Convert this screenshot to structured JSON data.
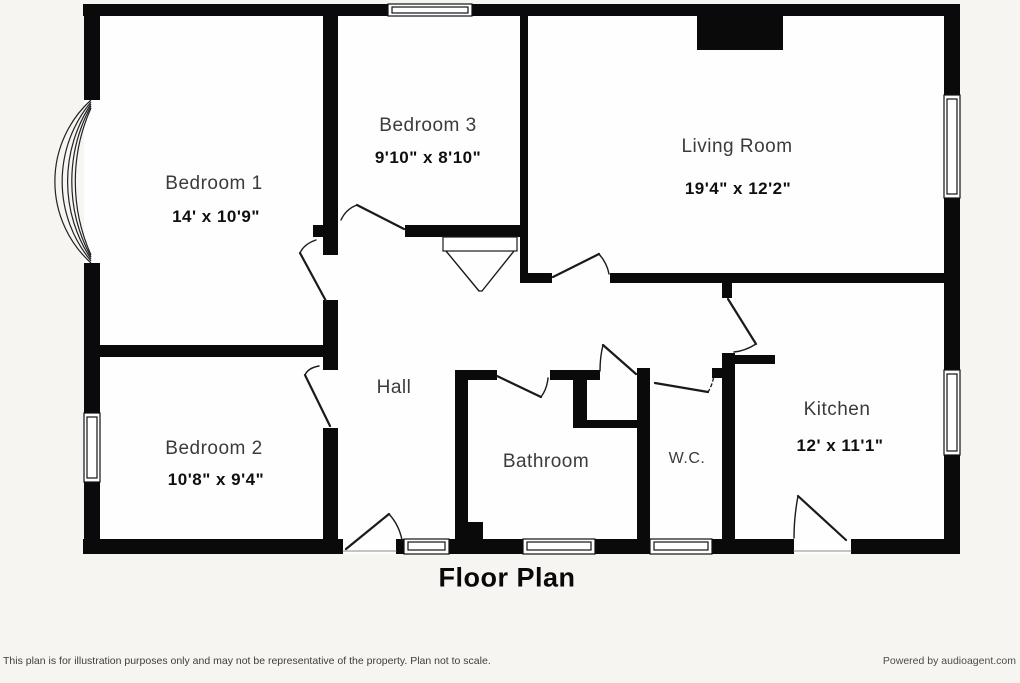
{
  "title": "Floor Plan",
  "palette": {
    "wall": "#0a0a0a",
    "room_fill": "#fefefe",
    "page_bg": "#f6f5f1",
    "label_color": "#3b3b3b",
    "dims_color": "#0f0f0f"
  },
  "rooms": {
    "bedroom1": {
      "name": "Bedroom 1",
      "dims": "14' x 10'9\""
    },
    "bedroom3": {
      "name": "Bedroom 3",
      "dims": "9'10\" x 8'10\""
    },
    "living": {
      "name": "Living Room",
      "dims": "19'4\" x 12'2\""
    },
    "bedroom2": {
      "name": "Bedroom 2",
      "dims": "10'8\" x 9'4\""
    },
    "hall": {
      "name": "Hall"
    },
    "bathroom": {
      "name": "Bathroom"
    },
    "wc": {
      "name": "W.C."
    },
    "kitchen": {
      "name": "Kitchen",
      "dims": "12' x 11'1\""
    }
  },
  "footer": {
    "disclaimer": "This plan is for illustration purposes only and may not be representative of the property. Plan not to scale.",
    "credit": "Powered by audioagent.com"
  }
}
